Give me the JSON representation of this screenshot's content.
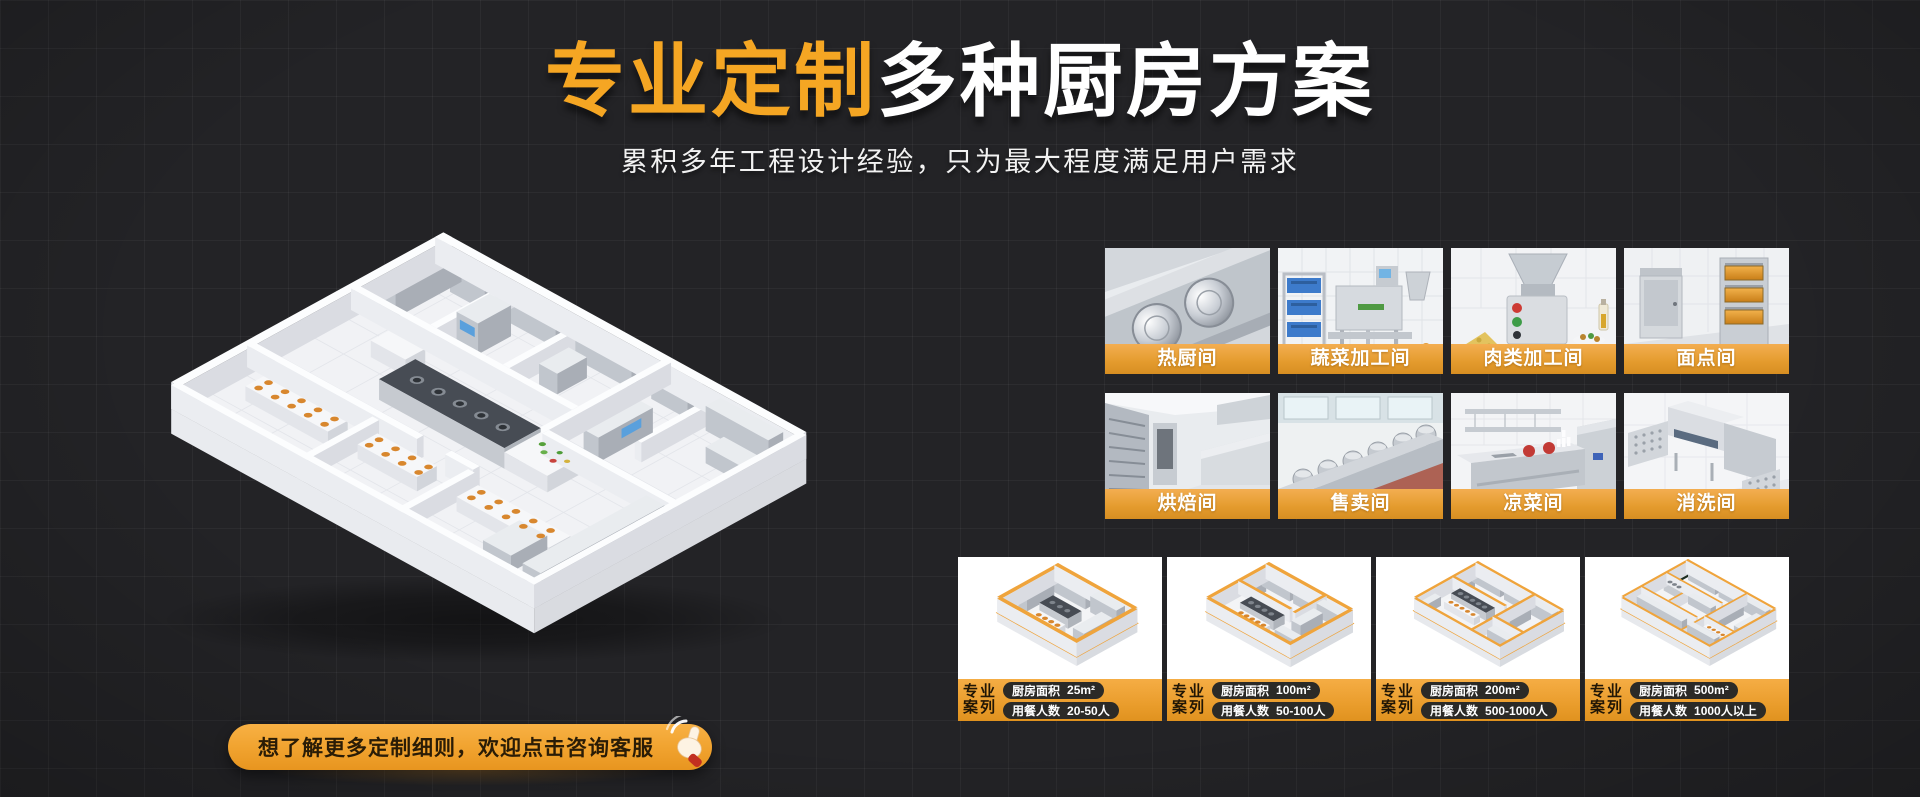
{
  "header": {
    "title_highlight": "专业定制",
    "title_rest": "多种厨房方案",
    "subtitle": "累积多年工程设计经验，只为最大程度满足用户需求"
  },
  "consult_button": {
    "label": "想了解更多定制细则，欢迎点击咨询客服",
    "icon": "hand-click-icon"
  },
  "room_tiles": [
    {
      "label": "热厨间",
      "icon": "hot-kitchen-photo"
    },
    {
      "label": "蔬菜加工间",
      "icon": "vegetable-processing-photo"
    },
    {
      "label": "肉类加工间",
      "icon": "meat-processing-photo"
    },
    {
      "label": "面点间",
      "icon": "pastry-room-photo"
    },
    {
      "label": "烘焙间",
      "icon": "baking-room-photo"
    },
    {
      "label": "售卖间",
      "icon": "sales-room-photo"
    },
    {
      "label": "凉菜间",
      "icon": "cold-dish-room-photo"
    },
    {
      "label": "消洗间",
      "icon": "dishwashing-room-photo"
    }
  ],
  "case_cards": [
    {
      "tag_line1": "专业",
      "tag_line2": "案列",
      "area_label": "厨房面积",
      "area_value": "25m²",
      "diners_label": "用餐人数",
      "diners_value": "20-50人"
    },
    {
      "tag_line1": "专业",
      "tag_line2": "案列",
      "area_label": "厨房面积",
      "area_value": "100m²",
      "diners_label": "用餐人数",
      "diners_value": "50-100人"
    },
    {
      "tag_line1": "专业",
      "tag_line2": "案列",
      "area_label": "厨房面积",
      "area_value": "200m²",
      "diners_label": "用餐人数",
      "diners_value": "500-1000人"
    },
    {
      "tag_line1": "专业",
      "tag_line2": "案列",
      "area_label": "厨房面积",
      "area_value": "500m²",
      "diners_label": "用餐人数",
      "diners_value": "1000人以上"
    }
  ],
  "colors": {
    "accent_orange": "#F5A623",
    "label_band_top": "#F3AE51",
    "label_band_bottom": "#D78E22",
    "background": "#232326",
    "pill_background": "#2B2A27",
    "title_white": "#FFFFFF"
  }
}
